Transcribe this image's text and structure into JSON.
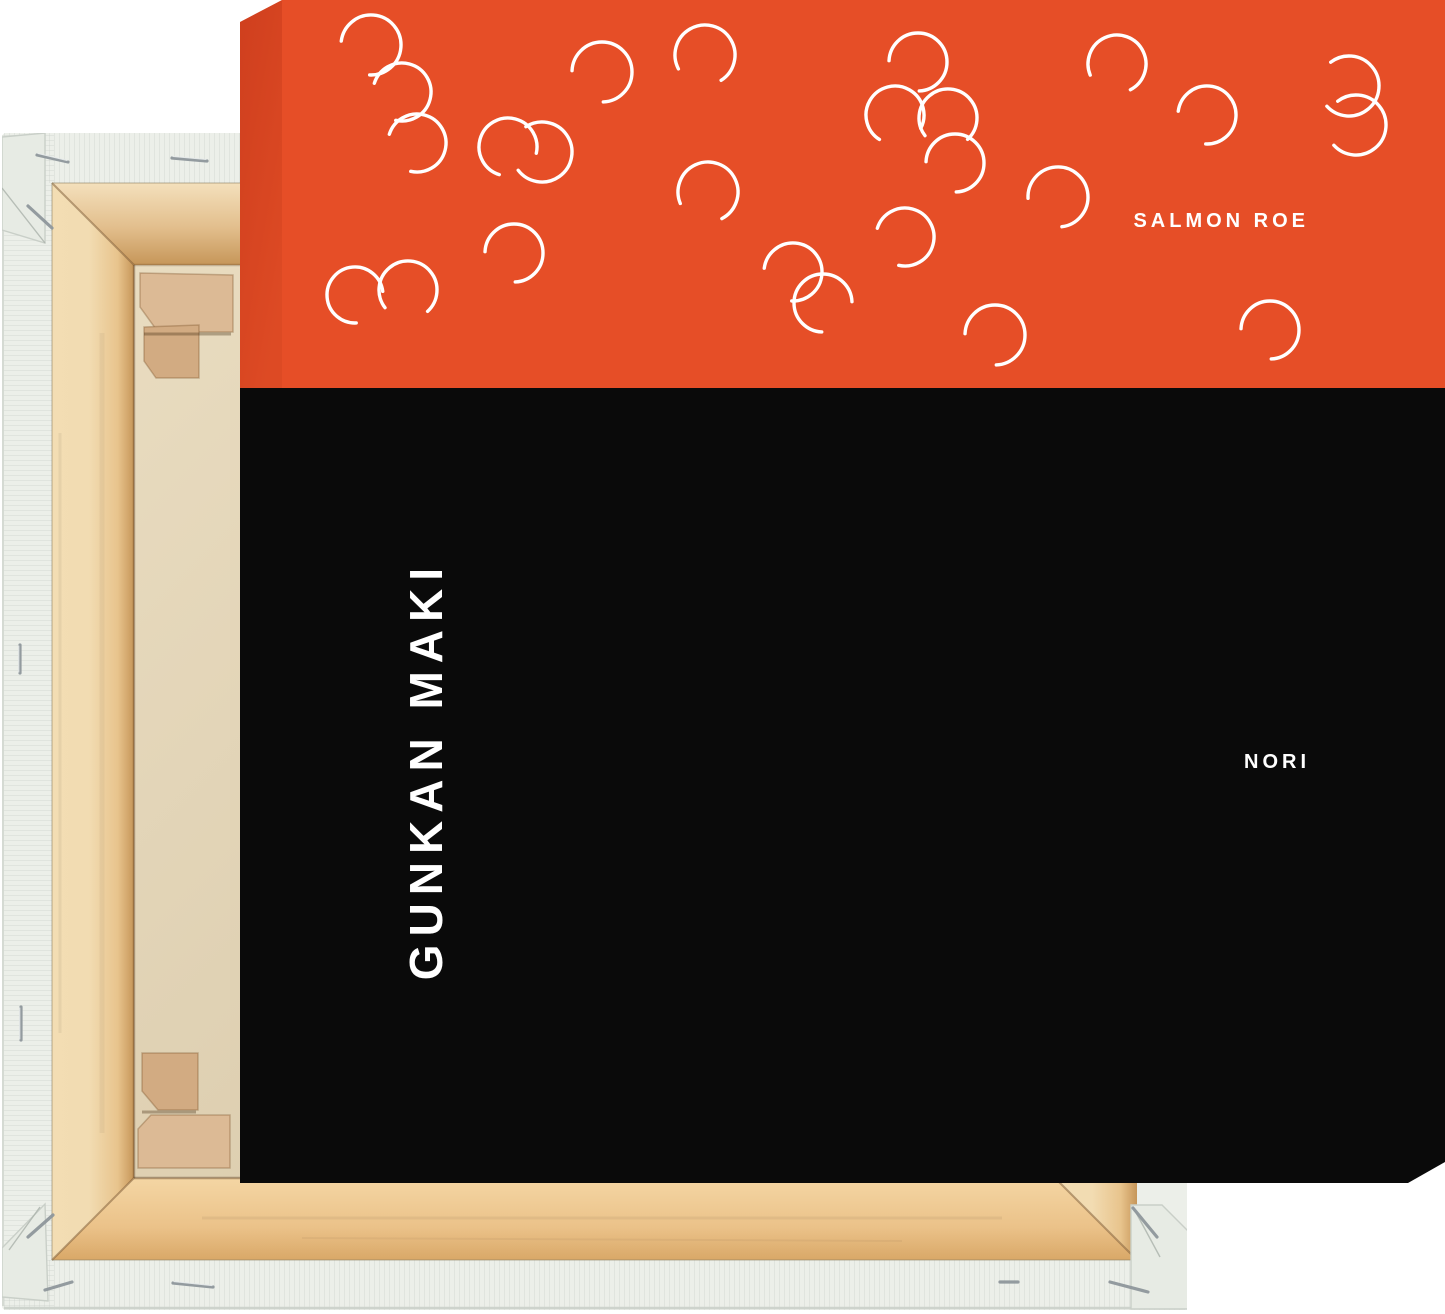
{
  "page": {
    "background": "#FFFFFF"
  },
  "print": {
    "top_label": "SALMON ROE",
    "bottom_label": "NORI",
    "side_title": "GUNKAN MAKI",
    "colors": {
      "roe": "#E64E27",
      "roe_side_dark": "#CF3F1E",
      "roe_side_light": "#DD4A24",
      "nori": "#0A0A0A",
      "label_text": "#FFFFFF"
    },
    "roe_band": {
      "height_px": 388,
      "arc_stroke": "#FFFFFF",
      "arc_stroke_width": 3.4,
      "arc_gap_degrees": 95
    },
    "arcs": [
      {
        "cx": 131,
        "cy": 45,
        "r": 30,
        "gap": 140
      },
      {
        "cx": 162,
        "cy": 92,
        "r": 29,
        "gap": 150
      },
      {
        "cx": 177,
        "cy": 143,
        "r": 29,
        "gap": 150
      },
      {
        "cx": 268,
        "cy": 147,
        "r": 29,
        "gap": 60
      },
      {
        "cx": 274,
        "cy": 253,
        "r": 29,
        "gap": 135
      },
      {
        "cx": 168,
        "cy": 290,
        "r": 29,
        "gap": 95
      },
      {
        "cx": 115,
        "cy": 295,
        "r": 28,
        "gap": 40
      },
      {
        "cx": 362,
        "cy": 72,
        "r": 30,
        "gap": 135
      },
      {
        "cx": 465,
        "cy": 55,
        "r": 30,
        "gap": 105
      },
      {
        "cx": 468,
        "cy": 192,
        "r": 30,
        "gap": 110
      },
      {
        "cx": 302,
        "cy": 152,
        "r": 30,
        "gap": 190
      },
      {
        "cx": 553,
        "cy": 272,
        "r": 29,
        "gap": 140
      },
      {
        "cx": 583,
        "cy": 303,
        "r": 29,
        "gap": 45
      },
      {
        "cx": 678,
        "cy": 62,
        "r": 29,
        "gap": 135
      },
      {
        "cx": 655,
        "cy": 115,
        "r": 29,
        "gap": 75
      },
      {
        "cx": 708,
        "cy": 118,
        "r": 29,
        "gap": 95
      },
      {
        "cx": 715,
        "cy": 163,
        "r": 29,
        "gap": 135
      },
      {
        "cx": 665,
        "cy": 237,
        "r": 29,
        "gap": 150
      },
      {
        "cx": 818,
        "cy": 197,
        "r": 30,
        "gap": 130
      },
      {
        "cx": 877,
        "cy": 64,
        "r": 29,
        "gap": 110
      },
      {
        "cx": 967,
        "cy": 115,
        "r": 29,
        "gap": 140
      },
      {
        "cx": 1109,
        "cy": 86,
        "r": 30,
        "gap": 185
      },
      {
        "cx": 1116,
        "cy": 125,
        "r": 30,
        "gap": 185
      },
      {
        "cx": 755,
        "cy": 335,
        "r": 30,
        "gap": 135
      },
      {
        "cx": 1030,
        "cy": 330,
        "r": 29,
        "gap": 135
      }
    ]
  },
  "frame_back": {
    "colors": {
      "canvas_white": "#ECEFE9",
      "canvas_white_shade": "#E7EBE4",
      "wood_light": "#F3DDB3",
      "wood_mid": "#E8C48D",
      "wood_dark": "#C69659",
      "wood_bottom_light": "#F4D6A4",
      "wood_bottom_dark": "#D9A868",
      "beige_light": "#E9DCC0",
      "beige_dark": "#D5C5A5",
      "wedge_light": "#DCBA95",
      "wedge_mid": "#D2AB82",
      "staple_metal": "#8F979C"
    }
  }
}
